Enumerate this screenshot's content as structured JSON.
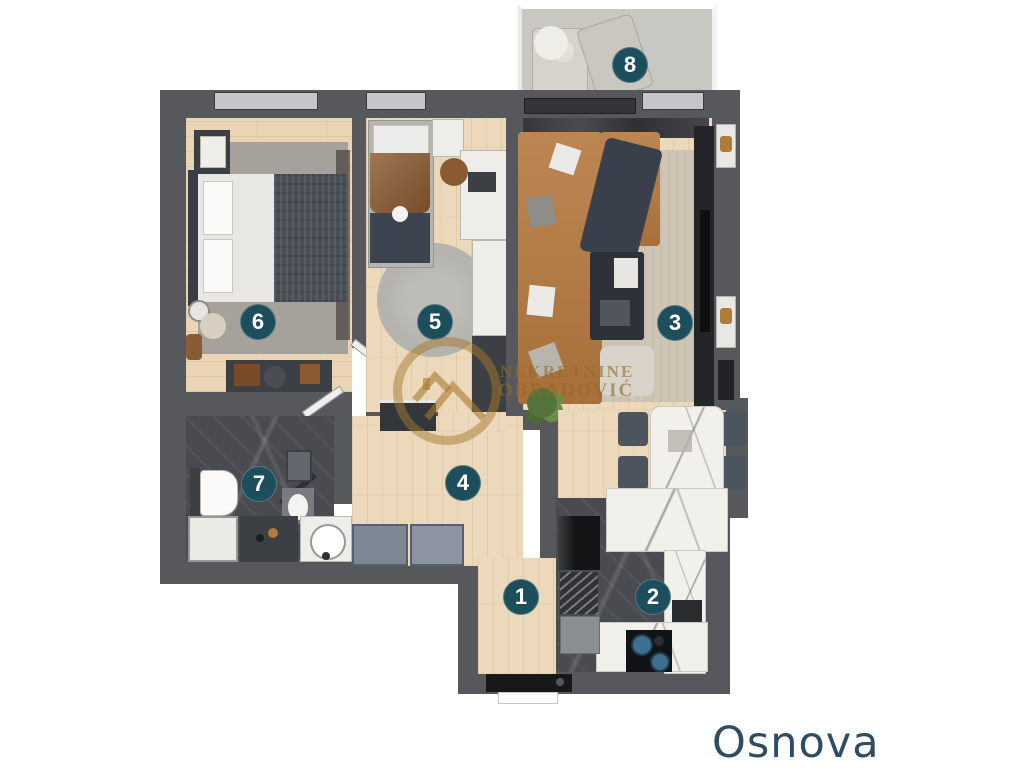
{
  "title": {
    "text": "Osnova",
    "color": "#2e4c63"
  },
  "watermark": {
    "line1": "NEKRETNINE",
    "line2": "OBRADOVIĆ",
    "color": "#a1762e"
  },
  "badge_style": {
    "background": "#1d4e5c",
    "text_color": "#ffffff"
  },
  "rooms": [
    {
      "label": "1"
    },
    {
      "label": "2"
    },
    {
      "label": "3"
    },
    {
      "label": "4"
    },
    {
      "label": "5"
    },
    {
      "label": "6"
    },
    {
      "label": "7"
    },
    {
      "label": "8"
    }
  ]
}
